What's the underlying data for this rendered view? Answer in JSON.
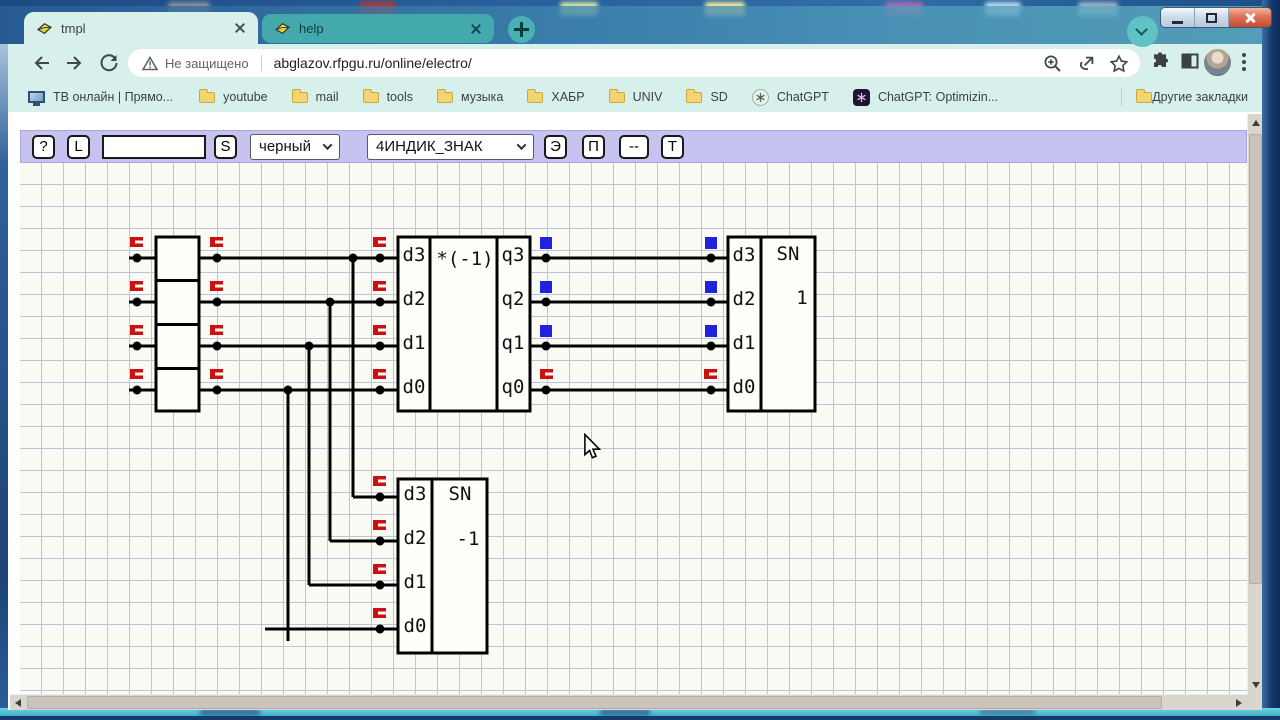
{
  "window": {
    "tabs": [
      {
        "title": "tmpl"
      },
      {
        "title": "help"
      }
    ]
  },
  "browser": {
    "security_label": "Не защищено",
    "url": "abglazov.rfpgu.ru/online/electro/",
    "bookmarks": [
      {
        "label": "ТВ онлайн | Прямо...",
        "icon": "monitor-icon"
      },
      {
        "label": "youtube",
        "icon": "folder-icon"
      },
      {
        "label": "mail",
        "icon": "folder-icon"
      },
      {
        "label": "tools",
        "icon": "folder-icon"
      },
      {
        "label": "музыка",
        "icon": "folder-icon"
      },
      {
        "label": "ХАБР",
        "icon": "folder-icon"
      },
      {
        "label": "UNIV",
        "icon": "folder-icon"
      },
      {
        "label": "SD",
        "icon": "folder-icon"
      },
      {
        "label": "ChatGPT",
        "icon": "chatgpt-icon-light"
      },
      {
        "label": "ChatGPT: Optimizin...",
        "icon": "chatgpt-icon-dark"
      }
    ],
    "other_bookmarks": "Другие закладки"
  },
  "app": {
    "toolbar": {
      "help": "?",
      "load": "L",
      "search_value": "",
      "save": "S",
      "color_select": "черный",
      "component_select": "4ИНДИК_ЗНАК",
      "element": "Э",
      "panel": "П",
      "wire": "--",
      "text": "Т"
    },
    "circuit": {
      "inverter": {
        "title": "*(-1)",
        "inputs": [
          "d3",
          "d2",
          "d1",
          "d0"
        ],
        "outputs": [
          "q3",
          "q2",
          "q1",
          "q0"
        ]
      },
      "indicator_top": {
        "title": "SN",
        "value": "1",
        "inputs": [
          "d3",
          "d2",
          "d1",
          "d0"
        ]
      },
      "indicator_bottom": {
        "title": "SN",
        "value": "-1",
        "inputs": [
          "d3",
          "d2",
          "d1",
          "d0"
        ]
      }
    },
    "colors": {
      "signal_on": "#2222dd",
      "signal_off": "#cc1111",
      "wire": "#000000",
      "toolbar_bg": "#c6c3f0",
      "grid_line": "#b9c7d8"
    }
  }
}
